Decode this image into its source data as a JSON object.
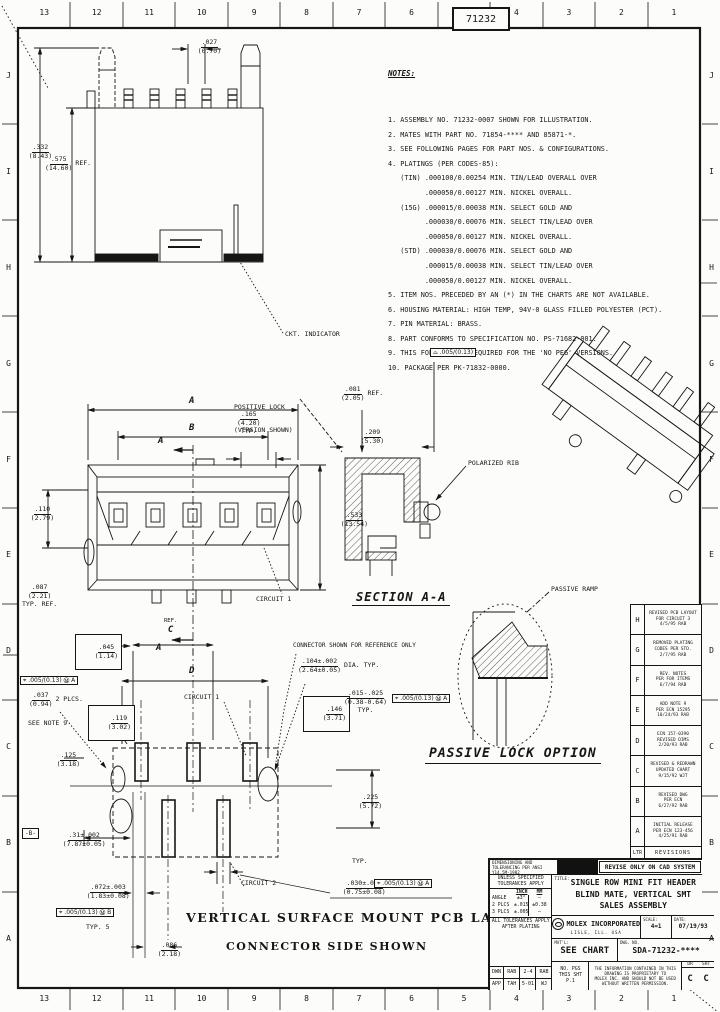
{
  "sheet": {
    "tab_number": "71232",
    "zone_cols": [
      "13",
      "12",
      "11",
      "10",
      "9",
      "8",
      "7",
      "6",
      "5",
      "4",
      "3",
      "2",
      "1"
    ],
    "zone_rows": [
      "J",
      "I",
      "H",
      "G",
      "F",
      "E",
      "D",
      "C",
      "B",
      "A"
    ]
  },
  "notes": {
    "title": "NOTES:",
    "lines": [
      "1. ASSEMBLY NO. 71232-0007 SHOWN FOR ILLUSTRATION.",
      "2. MATES WITH PART NO. 71854-**** AND 85871-*.",
      "3. SEE FOLLOWING PAGES FOR PART NOS. & CONFIGURATIONS.",
      "4. PLATINGS (PER CODES-85):",
      "   (TIN) .000100/0.00254 MIN. TIN/LEAD OVERALL OVER",
      "         .000050/0.00127 MIN. NICKEL OVERALL.",
      "   (15G) .000015/0.00038 MIN. SELECT GOLD AND",
      "         .000030/0.00076 MIN. SELECT TIN/LEAD OVER",
      "         .000050/0.00127 MIN. NICKEL OVERALL.",
      "   (STD) .000030/0.00076 MIN. SELECT GOLD AND",
      "         .000015/0.00038 MIN. SELECT TIN/LEAD OVER",
      "         .000050/0.00127 MIN. NICKEL OVERALL.",
      "5. ITEM NOS. PRECEDED BY AN (*) IN THE CHARTS ARE NOT AVAILABLE.",
      "6. HOUSING MATERIAL: HIGH TEMP, 94V-0 GLASS FILLED POLYESTER (PCT).",
      "7. PIN MATERIAL: BRASS.",
      "8. PART CONFORMS TO SPECIFICATION NO. PS-71682-001.",
      "9. THIS FOLD IS NOT REQUIRED FOR THE 'NO PEG' VERSIONS.",
      "10. PACKAGE PER PK-71832-0000."
    ]
  },
  "front_view": {
    "dim_width": {
      "top": ".027",
      "bot": "(0.70)"
    },
    "dim_height": {
      "top": ".332",
      "bot": "(8.43)"
    },
    "dim_ref": {
      "top": ".575",
      "bot": "(14.60)",
      "suffix": "REF."
    },
    "callout_indicator": "CKT. INDICATOR"
  },
  "plan_view": {
    "dim_a": "A",
    "dim_b": "B",
    "dim_typ": {
      "top": ".165",
      "bot": "(4.20)",
      "suffix": "TYP."
    },
    "dim_height": {
      "top": ".533",
      "bot": "(13.54)"
    },
    "dim_left": {
      "top": ".110",
      "bot": "(2.79)"
    },
    "dim_foot": {
      "top": ".087",
      "bot": "(2.21)",
      "suffix": "TYP. REF."
    },
    "callout_positive_lock_1": "POSITIVE LOCK",
    "callout_positive_lock_2": "(VERSION SHOWN)",
    "callout_circuit": "CIRCUIT 1",
    "section_letter": "A"
  },
  "section_view": {
    "title": "SECTION A-A",
    "dim_081": {
      "top": ".081",
      "bot": "(2.05)",
      "suffix": "REF."
    },
    "dim_209": {
      "top": ".209",
      "bot": "(5.30)"
    },
    "profile_frame": "⌓ .005/(0.13)",
    "callout_polarized_rib": "POLARIZED RIB"
  },
  "passive_detail": {
    "title": "PASSIVE LOCK OPTION",
    "callout_ramp": "PASSIVE RAMP"
  },
  "pcb_view": {
    "title_1": "VERTICAL SURFACE MOUNT PCB LAYOUT",
    "title_2": "CONNECTOR SIDE SHOWN",
    "callout_reference": "CONNECTOR SHOWN FOR REFERENCE ONLY",
    "dim_c": "C",
    "dim_c_ref": "REF.",
    "dim_d": "D",
    "circuit_1": "CIRCUIT 1",
    "circuit_2": "CIRCUIT 2",
    "box_045": {
      "top": ".045",
      "bot": "(1.14)"
    },
    "box_119": {
      "top": ".119",
      "bot": "(3.02)"
    },
    "fcf_a1": "⌖ .005/(0.13) Ⓜ A",
    "dim_037": {
      "top": ".037",
      "bot": "(0.94)",
      "suffix": "2 PLCS."
    },
    "see_note": "SEE NOTE 9",
    "dim_125": {
      "top": ".125",
      "bot": "(3.18)"
    },
    "datum_b": "-B-",
    "dim_31": {
      "top": ".31±.002",
      "bot": "(7.87±0.05)"
    },
    "dim_072": {
      "top": ".072±.003",
      "bot": "(1.83±0.08)"
    },
    "fcf_b": "⌖ .005/(0.13) Ⓜ B",
    "fcf_b_suffix": "TYP. 5",
    "dim_086": {
      "top": ".086",
      "bot": "(2.18)"
    },
    "dim_225": {
      "top": ".225",
      "bot": "(5.72)"
    },
    "typ_label": "TYP.",
    "dim_030": {
      "top": ".030±.003",
      "bot": "(0.75±0.08)"
    },
    "fcf_a2": "⌖ .005/(0.13) Ⓜ A",
    "dim_104": {
      "top": ".104±.002",
      "bot": "(2.64±0.05)",
      "suffix": "DIA. TYP."
    },
    "box_146": {
      "top": ".146",
      "bot": "(3.71)"
    },
    "dim_015": {
      "top": ".015-.025",
      "bot": "(0.38-0.64)",
      "suffix": "TYP."
    },
    "fcf_a3": "⌖ .005/(0.13) Ⓜ A"
  },
  "revisions": {
    "header_ltr": "LTR",
    "header_title": "REVISIONS",
    "rows": [
      {
        "ltr": "H",
        "l1": "REVISED PCB LAYOUT",
        "l2": "FOR CIRCUIT 3",
        "l3": "4/5/95  RAB"
      },
      {
        "ltr": "G",
        "l1": "REMOVED PLATING",
        "l2": "CODES PER STD.",
        "l3": "2/7/95  RAB"
      },
      {
        "ltr": "F",
        "l1": "REV. NOTES",
        "l2": "PER FOR ITEMS",
        "l3": "6/7/94  RAB"
      },
      {
        "ltr": "E",
        "l1": "ADD NOTE 9",
        "l2": "PER ECN 15295",
        "l3": "10/24/93  RAB"
      },
      {
        "ltr": "D",
        "l1": "ECN 157-0390",
        "l2": "REVISED DIMS",
        "l3": "2/20/93  RAB"
      },
      {
        "ltr": "C",
        "l1": "REVISED & REDRAWN",
        "l2": "UPDATED CHART",
        "l3": "9/15/92  WJT"
      },
      {
        "ltr": "B",
        "l1": "REVISED DWG",
        "l2": "PER ECN",
        "l3": "6/27/92  RAB"
      },
      {
        "ltr": "A",
        "l1": "INITIAL RELEASE",
        "l2": "PER ECN 123-456",
        "l3": "4/25/91  RAB"
      }
    ]
  },
  "title_block": {
    "stamp": "DIMENSIONING AND TOLERANCING PER ANSI Y14.5M-1982",
    "cad_banner": "REVISE ONLY ON CAD SYSTEM",
    "tol_header_1": "UNLESS SPECIFIED",
    "tol_header_2": "TOLERANCES APPLY",
    "tol_col_inch": "INCH",
    "tol_col_mm": "MM",
    "tol_rows": [
      {
        "label": "ANGLE",
        "inch": "±3°",
        "mm": "—"
      },
      {
        "label": "2 PLCS",
        "inch": "±.015",
        "mm": "±0.38"
      },
      {
        "label": "3 PLCS",
        "inch": "±.005",
        "mm": "—"
      }
    ],
    "tol_note_1": "ALL TOLERANCES APPLY",
    "tol_note_2": "AFTER PLATING",
    "sign_rows": [
      {
        "label": "DWN",
        "a": "RAB",
        "b": "2-4",
        "c": "RAB"
      },
      {
        "label": "APP",
        "a": "TAH",
        "b": "5-01",
        "c": "WJ"
      }
    ],
    "title_label": "TITLE:",
    "title_1": "SINGLE ROW MINI FIT HEADER",
    "title_2": "BLIND MATE, VERTICAL SMT",
    "title_3": "SALES ASSEMBLY",
    "company": "MOLEX INCORPORATED",
    "company_sub": "LISLE,  ILL.  USA",
    "scale_label": "SCALE:",
    "scale_value": "4=1",
    "date_label": "DATE:",
    "date_value": "07/19/93",
    "material_label": "MAT'L:",
    "material_value": "SEE CHART",
    "dwg_label": "DWG. NO.",
    "dwg_value": "SDA-71232-****",
    "sheet_l1": "NO. PGS",
    "sheet_l2": "THIS SHT",
    "sheet_l3": "P.1",
    "legal_1": "THE INFORMATION CONTAINED IN THIS DRAWING IS PROPRIETARY TO",
    "legal_2": "MOLEX INC. AND SHOULD NOT BE USED WITHOUT WRITTEN PERMISSION.",
    "rev_dr_label": "DR",
    "rev_sht_label": "SHT",
    "rev_dr": "C",
    "rev_sht": "C"
  }
}
